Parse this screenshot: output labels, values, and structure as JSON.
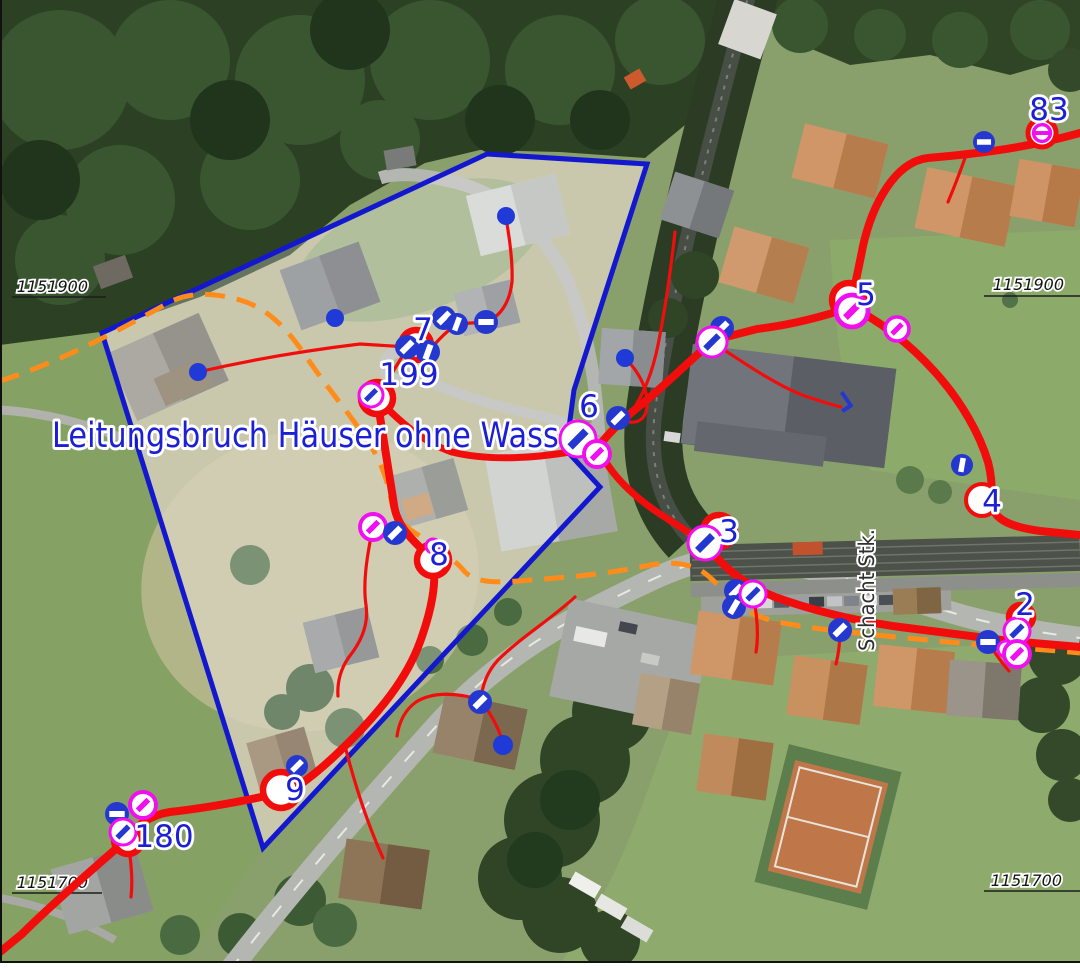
{
  "map": {
    "colors": {
      "pipe": "#f20d0d",
      "pipe_planned": "#ff8c1a",
      "selection": "#1318cf",
      "label_blue": "#1b1fd6",
      "valve_blue": "#2438cf",
      "valve_magenta": "#ef0fef",
      "grid_text": "#141414",
      "street_text": "#2f2f2f"
    },
    "annotation": {
      "text": "Leitungsbruch Häuser ohne Wasser",
      "x": 52,
      "y": 447,
      "size": 35,
      "length": 538
    },
    "street_label": {
      "text": "Schacht Stk.",
      "x": 874,
      "y": 590,
      "size": 21,
      "length": 122
    },
    "grid_labels": [
      {
        "text": "1151900",
        "x": 88,
        "y": 292
      },
      {
        "text": "1151900",
        "x": 1064,
        "y": 290
      },
      {
        "text": "1151700",
        "x": 88,
        "y": 888
      },
      {
        "text": "1151700",
        "x": 1062,
        "y": 886
      }
    ],
    "grid_lines": [
      {
        "x1": 12,
        "y1": 297,
        "x2": 106,
        "y2": 297
      },
      {
        "x1": 984,
        "y1": 296,
        "x2": 1080,
        "y2": 296
      },
      {
        "x1": 12,
        "y1": 893,
        "x2": 102,
        "y2": 893
      },
      {
        "x1": 984,
        "y1": 891,
        "x2": 1080,
        "y2": 891
      }
    ],
    "node_labels": [
      {
        "text": "83",
        "x": 1049,
        "y": 109
      },
      {
        "text": "5",
        "x": 866,
        "y": 294
      },
      {
        "text": "7",
        "x": 423,
        "y": 329
      },
      {
        "text": "199",
        "x": 409,
        "y": 374
      },
      {
        "text": "6",
        "x": 589,
        "y": 406
      },
      {
        "text": "3",
        "x": 729,
        "y": 531
      },
      {
        "text": "4",
        "x": 992,
        "y": 501
      },
      {
        "text": "2",
        "x": 1025,
        "y": 604
      },
      {
        "text": "8",
        "x": 439,
        "y": 554
      },
      {
        "text": "9",
        "x": 295,
        "y": 789
      },
      {
        "text": "180",
        "x": 164,
        "y": 836
      }
    ],
    "symbols": [
      {
        "t": "vbh",
        "x": 984,
        "y": 142,
        "r": 11
      },
      {
        "t": "hm",
        "x": 1042,
        "y": 133,
        "r": 14
      },
      {
        "t": "nr",
        "x": 849,
        "y": 300,
        "r": 17
      },
      {
        "t": "vm",
        "x": 852,
        "y": 311,
        "r": 16
      },
      {
        "t": "vm",
        "x": 897,
        "y": 329,
        "r": 12
      },
      {
        "t": "vb",
        "x": 722,
        "y": 328,
        "r": 12
      },
      {
        "t": "vwb",
        "x": 712,
        "y": 342,
        "r": 15
      },
      {
        "t": "vb",
        "x": 618,
        "y": 418,
        "r": 12
      },
      {
        "t": "vwb",
        "x": 578,
        "y": 439,
        "r": 18
      },
      {
        "t": "vm",
        "x": 597,
        "y": 454,
        "r": 13
      },
      {
        "t": "nr",
        "x": 416,
        "y": 345,
        "r": 15
      },
      {
        "t": "vb",
        "x": 407,
        "y": 347,
        "r": 12
      },
      {
        "t": "vb",
        "x": 428,
        "y": 352,
        "r": 12,
        "a": -70
      },
      {
        "t": "vb",
        "x": 444,
        "y": 318,
        "r": 12
      },
      {
        "t": "vb",
        "x": 457,
        "y": 324,
        "r": 11,
        "a": -70
      },
      {
        "t": "vbh",
        "x": 486,
        "y": 322,
        "r": 12
      },
      {
        "t": "nr",
        "x": 377,
        "y": 398,
        "r": 16
      },
      {
        "t": "vwb",
        "x": 371,
        "y": 395,
        "r": 12
      },
      {
        "t": "vm",
        "x": 373,
        "y": 527,
        "r": 13
      },
      {
        "t": "vb",
        "x": 395,
        "y": 533,
        "r": 12
      },
      {
        "t": "nr",
        "x": 433,
        "y": 560,
        "r": 16
      },
      {
        "t": "mr",
        "x": 433,
        "y": 546,
        "r": 7
      },
      {
        "t": "vb",
        "x": 480,
        "y": 702,
        "r": 12
      },
      {
        "t": "nr",
        "x": 281,
        "y": 790,
        "r": 18
      },
      {
        "t": "vb",
        "x": 297,
        "y": 766,
        "r": 11
      },
      {
        "t": "vm",
        "x": 143,
        "y": 805,
        "r": 13
      },
      {
        "t": "vbh",
        "x": 117,
        "y": 814,
        "r": 12
      },
      {
        "t": "nr",
        "x": 128,
        "y": 840,
        "r": 14
      },
      {
        "t": "vwb",
        "x": 123,
        "y": 832,
        "r": 13
      },
      {
        "t": "nr",
        "x": 719,
        "y": 531,
        "r": 16
      },
      {
        "t": "vwb",
        "x": 705,
        "y": 543,
        "r": 17
      },
      {
        "t": "vb",
        "x": 736,
        "y": 591,
        "r": 12
      },
      {
        "t": "vb",
        "x": 734,
        "y": 607,
        "r": 12,
        "a": -60
      },
      {
        "t": "vwb",
        "x": 753,
        "y": 594,
        "r": 13
      },
      {
        "t": "vb",
        "x": 840,
        "y": 630,
        "r": 12
      },
      {
        "t": "vbh",
        "x": 988,
        "y": 642,
        "r": 12
      },
      {
        "t": "nr",
        "x": 1021,
        "y": 617,
        "r": 12
      },
      {
        "t": "vwb",
        "x": 1017,
        "y": 631,
        "r": 13
      },
      {
        "t": "mr",
        "x": 1006,
        "y": 649,
        "r": 8
      },
      {
        "t": "vm",
        "x": 1017,
        "y": 654,
        "r": 13
      },
      {
        "t": "nw",
        "x": 982,
        "y": 500,
        "r": 16
      },
      {
        "t": "vb",
        "x": 962,
        "y": 465,
        "r": 11,
        "a": -80
      },
      {
        "t": "dot",
        "x": 506,
        "y": 216,
        "r": 9
      },
      {
        "t": "dot",
        "x": 335,
        "y": 318,
        "r": 9
      },
      {
        "t": "dot",
        "x": 198,
        "y": 372,
        "r": 9
      },
      {
        "t": "dot",
        "x": 625,
        "y": 358,
        "r": 9
      },
      {
        "t": "dot",
        "x": 503,
        "y": 745,
        "r": 10
      },
      {
        "t": "hook",
        "x": 843,
        "y": 402,
        "r": 10
      }
    ]
  }
}
